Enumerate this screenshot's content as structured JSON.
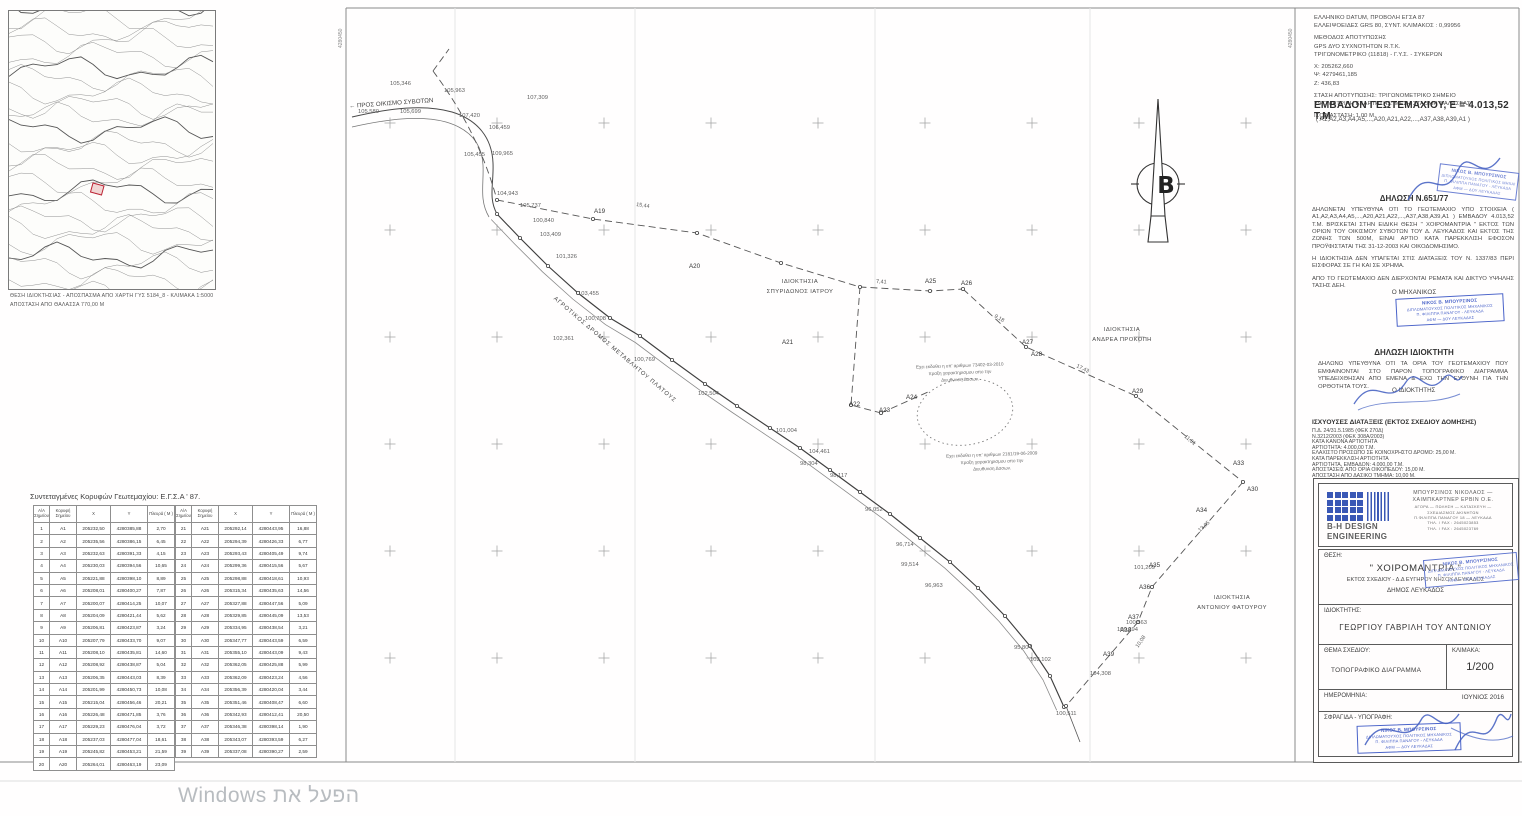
{
  "watermark": {
    "text": "הפעל את Windows"
  },
  "inset_map": {
    "caption_line1": "ΘΕΣΗ ΙΔΙΟΚΤΗΣΙΑΣ - ΑΠΟΣΠΑΣΜΑ ΑΠΟ ΧΑΡΤΗ ΓΥΣ 5184_8 - ΚΛΙΜΑΚΑ 1:5000",
    "caption_line2": "ΑΠΟΣΤΑΣΗ ΑΠΟ ΘΑΛΑΣΣΑ 770,00 Μ"
  },
  "survey_info": {
    "lines": [
      "ΕΛΛΗΝΙΚΟ DATUM, ΠΡΟΒΟΛΗ ΕΓΣΑ 87",
      "ΕΛΛΕΙΨΟΕΙΔΕΣ GRS 80, ΣΥΝΤ. ΚΛΙΜΑΚΟΣ :  0,99956",
      "ΜΕΘΟΔΟΣ ΑΠΟΤΥΠΩΣΗΣ",
      "GPS ΔΥΟ ΣΥΧΝΟΤΗΤΩΝ  R.T.K.",
      "ΤΡΙΓΩΝΟΜΕΤΡΙΚΟ (11818) - Γ.Υ.Σ. - ΣΥΚΕΡΩΝ",
      "X: 205262,660",
      "Ψ: 4279461,185",
      "Z: 436,83",
      "ΣΤΑΣΗ ΑΠΟΤΥΠΩΣΗΣ: ΤΡΙΓΩΝΟΜΕΤΡΙΚΟ ΣΗΜΕΙΟ",
      "ΥΨΟΜΕΤΡΙΚΗ ΕΞΑΡΤΗΣΗΣ: ΜΕΣΗ ΣΤΑΘΜΗ ΘΑΛΑΣΣΑΣ",
      "ΙΣΟΔΙΑΣΤΑΣΗ: 1,00 Μ."
    ]
  },
  "area": {
    "heading": "ΕΜΒΑΔΟΝ ΓΕΩΤΕΜΑΧΙΟΥ, Ε = 4.013,52 Τ.Μ",
    "vertices": "( Α1,Α2,Α3,Α4,Α5,...,Α20,Α21,Α22,...,Α37,Α38,Α39,Α1 )"
  },
  "declaration_651": {
    "title": "ΔΗΛΩΣΗ Ν.651/77",
    "paragraphs": [
      "ΔΗΛΩΝΕΤΑΙ ΥΠΕΥΘΥΝΑ ΟΤΙ ΤΟ ΓΕΩΤΕΜΑΧΙΟ ΥΠΟ ΣΤΟΙΧΕΙΑ ( Α1,Α2,Α3,Α4,Α5,...,Α20,Α21,Α22,...,Α37,Α38,Α39,Α1 ) ΕΜΒΑΔΟΥ 4.013,52 Τ.Μ. ΒΡΙΣΚΕΤΑΙ ΣΤΗΝ ΕΙΔΙΚΗ ΘΕΣΗ \" ΧΟΙΡΟΜΑΝΤΡΙΑ \" ΕΚΤΟΣ ΤΩΝ ΟΡΙΩΝ ΤΟΥ ΟΙΚΙΣΜΟΥ ΣΥΒΟΤΩΝ ΤΟΥ Δ. ΛΕΥΚΑΔΟΣ ΚΑΙ ΕΚΤΟΣ ΤΗΣ ΖΩΝΗΣ ΤΩΝ 500Μ, ΕΙΝΑΙ ΑΡΤΙΟ ΚΑΤΑ ΠΑΡΕΚΚΛΙΣΗ ΕΦΟΣΟΝ ΠΡΟΫΦΙΣΤΑΤΑΙ ΤΗΣ 31-12-2003 ΚΑΙ ΟΙΚΟΔΟΜΗΣΙΜΟ.",
      "Η ΙΔΙΟΚΤΗΣΙΑ ΔΕΝ ΥΠΑΓΕΤΑΙ ΣΤΙΣ ΔΙΑΤΑΞΕΙΣ ΤΟΥ Ν. 1337/83 ΠΕΡΙ ΕΙΣΦΟΡΑΣ ΣΕ ΓΗ ΚΑΙ ΣΕ ΧΡΗΜΑ.",
      "ΑΠΟ ΤΟ ΓΕΩΤΕΜΑΧΙΟ ΔΕΝ ΔΙΕΡΧΟΝΤΑΙ ΡΕΜΑΤΑ ΚΑΙ ΔΙΚΤΥΟ ΥΨΗΛΗΣ ΤΑΣΗΣ ΔΕΗ."
    ],
    "signer": "Ο ΜΗΧΑΝΙΚΟΣ"
  },
  "declaration_owner": {
    "title": "ΔΗΛΩΣΗ ΙΔΙΟΚΤΗΤΗ",
    "body": "ΔΗΛΩΝΩ ΥΠΕΥΘΥΝΑ ΟΤΙ ΤΑ ΟΡΙΑ ΤΟΥ ΓΕΩΤΕΜΑΧΙΟΥ ΠΟΥ ΕΜΦΑΙΝΟΝΤΑΙ ΣΤΟ ΠΑΡΟΝ ΤΟΠΟΓΡΑΦΙΚΟ ΔΙΑΓΡΑΜΜΑ ΥΠΕΔΕΙΧΘΗΣΑΝ ΑΠΟ ΕΜΕΝΑ & ΕΧΩ ΤΗΝ ΕΥΘΥΝΗ ΓΙΑ ΤΗΝ ΟΡΘΟΤΗΤΑ ΤΟΥΣ.",
    "signer": "Ο ΙΔΙΟΚΤΗΤΗΣ"
  },
  "provisions": {
    "title": "ΙΣΧΥΟΥΣΕΣ ΔΙΑΤΑΞΕΙΣ (ΕΚΤΟΣ ΣΧΕΔΙΟΥ ΔΟΜΗΣΗΣ)",
    "lines": [
      "Π.Δ. 24/31.5.1985 (ΦΕΚ 270Δ)",
      "Ν.3212/2003 (ΦΕΚ 308Α/2003)",
      "ΚΑΤΑ ΚΑΝΟΝΑ ΑΡΤΙΟΤΗΤΑ",
      "ΑΡΤΙΟΤΗΤΑ: 4.000,00 Τ.Μ.",
      "ΕΛΑΧΙΣΤΟ ΠΡΟΣΩΠΟ ΣΕ ΚΟΙΝΟΧΡΗΣΤΟ ΔΡΟΜΟ: 25,00 Μ.",
      "ΚΑΤΑ ΠΑΡΕΚΚΛΙΣΗ ΑΡΤΙΟΤΗΤΑ",
      "ΑΡΤΙΟΤΗΤΑ, ΕΜΒΑΔΟΝ: 4.000,00 Τ.Μ.",
      "ΑΠΟΣΤΑΣΕΙΣ ΑΠΟ ΟΡΙΑ ΟΙΚΟΠΕΔΟΥ: 15,00 Μ.",
      "ΑΠΟΣΤΑΣΗ ΑΠΟ ΔΑΣΙΚΟ ΤΜΗΜΑ: 10,00 Μ."
    ]
  },
  "title_block": {
    "brand_line1": "B-H DESIGN",
    "brand_line2": "ENGINEERING",
    "company_lines": [
      "ΜΠΟΥΡΣΙΝΟΣ ΝΙΚΟΛΑΟΣ —",
      "ΧΑΙΜΠΚΑΡΤΝΕΡ ΕΡΒΙΝ Ο.Ε."
    ],
    "detail_lines": [
      "ΑΓΟΡΑ — ΠΩΛΗΣΗ — ΚΑΤΑΣΚΕΥΗ —",
      "ΣΧΕΔΙΑΣΜΟΣ ΑΚΙΝΗΤΩΝ",
      "Π.ΦΙΛΙΠΠΑ ΠΑΝΑΓΟΥ 18 — ΛΕΥΚΑΔΑ",
      "ΤΗΛ. / FAX : 2645023853",
      "ΤΗΛ. / FAX : 2645023769"
    ],
    "thesi_label": "ΘΕΣΗ:",
    "thesi_value1": "\" ΧΟΙΡΟΜΑΝΤΡΙΑ \"",
    "thesi_value2": "ΕΚΤΟΣ ΣΧΕΔΙΟΥ - Δ.Δ ΕΥΓΗΡΟΥ ΝΗΣΟΥ ΛΕΥΚΑΔΟΣ",
    "thesi_value3": "ΔΗΜΟΣ ΛΕΥΚΑΔΟΣ",
    "owner_label": "ΙΔΙΟΚΤΗΤΗΣ:",
    "owner_value": "ΓΕΩΡΓΙΟΥ  ΓΑΒΡΙΛΗ ΤΟΥ ΑΝΤΩΝΙΟΥ",
    "subject_label": "ΘΕΜΑ ΣΧΕΔΙΟΥ:",
    "subject_value": "ΤΟΠΟΓΡΑΦΙΚΟ ΔΙΑΓΡΑΜΜΑ",
    "scale_label": "ΚΛΙΜΑΚΑ:",
    "scale_value": "1/200",
    "date_label": "ΗΜΕΡΟΜΗΝΙΑ:",
    "date_value": "ΙΟΥΝΙΟΣ  2016",
    "stamp_label": "ΣΦΡΑΓΙΔΑ - ΥΠΟΓΡΑΦΗ:"
  },
  "stamp": {
    "lines": [
      "ΝΙΚΟΣ Β. ΜΠΟΥΡΣΙΝΟΣ",
      "ΔΙΠΛΩΜΑΤΟΥΧΟΣ ΠΟΛΙΤΙΚΟΣ ΜΗΧΑΝΙΚΟΣ",
      "Π. ΦΙΛΙΠΠΑ ΠΑΝΑΓΟΥ - ΛΕΥΚΑΔΑ",
      "ΑΦΜ — ΔΟΥ ΛΕΥΚΑΔΑΣ"
    ]
  },
  "coords_table": {
    "title": "Συντεταγμένες Κορυφών Γεωτεμαχίου: Ε.Γ.Σ.Α ' 87.",
    "headers": [
      "Α/Α Σημείου",
      "Κορυφή Σημείου",
      "Χ",
      "Υ",
      "Πλευρά ( Μ )"
    ],
    "rows": [
      [
        "1",
        "Α1",
        "205232,50",
        "4280385,88",
        "2,70"
      ],
      [
        "2",
        "Α2",
        "205235,56",
        "4280386,15",
        "6,45"
      ],
      [
        "3",
        "Α3",
        "205232,63",
        "4280391,33",
        "4,15"
      ],
      [
        "4",
        "Α4",
        "205230,03",
        "4280394,56",
        "10,65"
      ],
      [
        "5",
        "Α5",
        "205221,88",
        "4280398,10",
        "8,89"
      ],
      [
        "6",
        "Α6",
        "205208,01",
        "4280400,27",
        "7,87"
      ],
      [
        "7",
        "Α7",
        "205200,07",
        "4280414,25",
        "10,07"
      ],
      [
        "8",
        "Α8",
        "205204,09",
        "4280421,44",
        "5,62"
      ],
      [
        "9",
        "Α9",
        "205206,81",
        "4280423,87",
        "3,24"
      ],
      [
        "10",
        "Α10",
        "205207,79",
        "4280433,70",
        "9,07"
      ],
      [
        "11",
        "Α11",
        "205208,10",
        "4280435,81",
        "14,60"
      ],
      [
        "12",
        "Α12",
        "205208,92",
        "4280438,87",
        "5,04"
      ],
      [
        "13",
        "Α13",
        "205206,35",
        "4280443,03",
        "8,39"
      ],
      [
        "14",
        "Α14",
        "205201,99",
        "4280450,73",
        "10,08"
      ],
      [
        "15",
        "Α15",
        "205215,04",
        "4280456,46",
        "20,21"
      ],
      [
        "16",
        "Α16",
        "205226,48",
        "4280471,85",
        "3,76"
      ],
      [
        "17",
        "Α17",
        "205229,23",
        "4280476,04",
        "3,72"
      ],
      [
        "18",
        "Α18",
        "205237,03",
        "4280477,04",
        "18,61"
      ],
      [
        "19",
        "Α19",
        "205245,82",
        "4280453,21",
        "21,59"
      ],
      [
        "20",
        "Α20",
        "205264,01",
        "4280463,19",
        "23,09"
      ],
      [
        "21",
        "Α21",
        "205292,14",
        "4280443,95",
        "16,88"
      ],
      [
        "22",
        "Α22",
        "205294,39",
        "4280426,33",
        "6,77"
      ],
      [
        "23",
        "Α23",
        "205293,43",
        "4280405,49",
        "9,74"
      ],
      [
        "24",
        "Α24",
        "205299,36",
        "4280415,56",
        "5,67"
      ],
      [
        "25",
        "Α25",
        "205298,88",
        "4280418,61",
        "10,93"
      ],
      [
        "26",
        "Α26",
        "205315,34",
        "4280435,63",
        "14,56"
      ],
      [
        "27",
        "Α27",
        "205327,88",
        "4280447,56",
        "5,09"
      ],
      [
        "28",
        "Α28",
        "205329,85",
        "4280445,09",
        "13,53"
      ],
      [
        "29",
        "Α29",
        "205334,95",
        "4280438,54",
        "3,21"
      ],
      [
        "30",
        "Α30",
        "205347,77",
        "4280443,59",
        "6,59"
      ],
      [
        "31",
        "Α31",
        "205355,10",
        "4280443,09",
        "9,43"
      ],
      [
        "32",
        "Α32",
        "205362,05",
        "4280425,88",
        "5,99"
      ],
      [
        "33",
        "Α33",
        "205362,09",
        "4280423,24",
        "4,56"
      ],
      [
        "34",
        "Α34",
        "205356,39",
        "4280420,04",
        "3,44"
      ],
      [
        "35",
        "Α35",
        "205351,46",
        "4280408,47",
        "6,60"
      ],
      [
        "36",
        "Α36",
        "205342,93",
        "4280412,41",
        "20,50"
      ],
      [
        "37",
        "Α37",
        "205346,38",
        "4280398,14",
        "1,90"
      ],
      [
        "38",
        "Α38",
        "205343,07",
        "4280393,59",
        "6,27"
      ],
      [
        "39",
        "Α39",
        "205337,08",
        "4280390,27",
        "2,59"
      ]
    ]
  },
  "drawing": {
    "direction_label": "← ΠΡΟΣ ΟΙΚΙΣΜΟ ΣΥΒΟΤΩΝ",
    "road_label": "ΑΓΡΟΤΙΚΟΣ ΔΡΟΜΟΣ ΜΕΤΑΒΛΗΤΟΥ ΠΛΑΤΟΥΣ",
    "north_letter": "Β",
    "owners": [
      {
        "line1": "ΙΔΙΟΚΤΗΣΙΑ",
        "line2": "ΣΠΥΡΙΔΩΝΟΣ ΙΑΤΡΟΥ",
        "x": 800,
        "y": 278
      },
      {
        "line1": "ΙΔΙΟΚΤΗΣΙΑ",
        "line2": "ΑΝΔΡΕΑ ΠΡΟΚΟΠΗ",
        "x": 1122,
        "y": 326
      },
      {
        "line1": "ΙΔΙΟΚΤΗΣΙΑ",
        "line2": "ΑΝΤΩΝΙΟΥ ΦΑΤΟΥΡΟΥ",
        "x": 1232,
        "y": 594
      }
    ],
    "notes": [
      {
        "x": 898,
        "y": 363,
        "lines": [
          "Εχει εκδοθει η υπ' αριθμων 73402-03-2010",
          "πραξη χαρακτηρισμου απο την",
          "Διευθυνση Δασων."
        ]
      },
      {
        "x": 930,
        "y": 452,
        "lines": [
          "Εχει εκδοθει η υπ' αριθμων 2181/19-06-2009",
          "πραξη χαρακτηρισμου απο την",
          "Διευθυνση Δασων."
        ]
      }
    ],
    "grid_labels": [
      {
        "t": "4280450",
        "x": 342,
        "y": 48
      },
      {
        "t": "4280450",
        "x": 1292,
        "y": 48
      }
    ],
    "point_labels": [
      {
        "t": "105,346",
        "x": 390,
        "y": 85
      },
      {
        "t": "105,963",
        "x": 444,
        "y": 92
      },
      {
        "t": "107,309",
        "x": 527,
        "y": 99
      },
      {
        "t": "105,580",
        "x": 358,
        "y": 113
      },
      {
        "t": "105,699",
        "x": 400,
        "y": 113
      },
      {
        "t": "107,420",
        "x": 459,
        "y": 117
      },
      {
        "t": "106,459",
        "x": 489,
        "y": 129
      },
      {
        "t": "105,455",
        "x": 464,
        "y": 156
      },
      {
        "t": "109,965",
        "x": 492,
        "y": 155
      },
      {
        "t": "104,943",
        "x": 497,
        "y": 195
      },
      {
        "t": "105,737",
        "x": 520,
        "y": 207
      },
      {
        "t": "100,840",
        "x": 533,
        "y": 222
      },
      {
        "t": "103,409",
        "x": 540,
        "y": 236
      },
      {
        "t": "101,326",
        "x": 556,
        "y": 258
      },
      {
        "t": "103,455",
        "x": 578,
        "y": 295
      },
      {
        "t": "100,708",
        "x": 585,
        "y": 320
      },
      {
        "t": "102,361",
        "x": 553,
        "y": 340
      },
      {
        "t": "100,769",
        "x": 634,
        "y": 361
      },
      {
        "t": "102,504",
        "x": 698,
        "y": 395
      },
      {
        "t": "101,004",
        "x": 776,
        "y": 432
      },
      {
        "t": "104,461",
        "x": 809,
        "y": 453
      },
      {
        "t": "98,304",
        "x": 800,
        "y": 465
      },
      {
        "t": "98,117",
        "x": 830,
        "y": 477
      },
      {
        "t": "96,052",
        "x": 865,
        "y": 511
      },
      {
        "t": "96,714",
        "x": 896,
        "y": 546
      },
      {
        "t": "99,514",
        "x": 901,
        "y": 566
      },
      {
        "t": "96,963",
        "x": 925,
        "y": 587
      },
      {
        "t": "95,804",
        "x": 1014,
        "y": 649
      },
      {
        "t": "102,102",
        "x": 1030,
        "y": 661
      },
      {
        "t": "104,308",
        "x": 1090,
        "y": 675
      },
      {
        "t": "100,511",
        "x": 1056,
        "y": 715
      },
      {
        "t": "100,563",
        "x": 1126,
        "y": 624
      },
      {
        "t": "101,209",
        "x": 1134,
        "y": 569
      },
      {
        "t": "100,394",
        "x": 1117,
        "y": 631
      }
    ],
    "vertex_labels": [
      {
        "t": "Α19",
        "x": 594,
        "y": 213
      },
      {
        "t": "Α20",
        "x": 689,
        "y": 268
      },
      {
        "t": "Α21",
        "x": 782,
        "y": 344
      },
      {
        "t": "Α22",
        "x": 849,
        "y": 406
      },
      {
        "t": "Α23",
        "x": 879,
        "y": 412
      },
      {
        "t": "Α24",
        "x": 906,
        "y": 399
      },
      {
        "t": "Α25",
        "x": 925,
        "y": 283
      },
      {
        "t": "Α26",
        "x": 961,
        "y": 285
      },
      {
        "t": "Α27",
        "x": 1022,
        "y": 344
      },
      {
        "t": "Α28",
        "x": 1031,
        "y": 356
      },
      {
        "t": "Α29",
        "x": 1132,
        "y": 393
      },
      {
        "t": "Α30",
        "x": 1247,
        "y": 491
      },
      {
        "t": "Α33",
        "x": 1233,
        "y": 465
      },
      {
        "t": "Α34",
        "x": 1196,
        "y": 512
      },
      {
        "t": "Α35",
        "x": 1149,
        "y": 567
      },
      {
        "t": "Α36",
        "x": 1139,
        "y": 589
      },
      {
        "t": "Α37",
        "x": 1128,
        "y": 619
      },
      {
        "t": "Α38",
        "x": 1120,
        "y": 632
      },
      {
        "t": "Α39",
        "x": 1103,
        "y": 656
      }
    ],
    "distance_labels": [
      {
        "t": "15,44",
        "x": 636,
        "y": 206,
        "r": 8
      },
      {
        "t": "7,41",
        "x": 876,
        "y": 283,
        "r": 3
      },
      {
        "t": "9,18",
        "x": 994,
        "y": 317,
        "r": 30
      },
      {
        "t": "17,43",
        "x": 1076,
        "y": 367,
        "r": 26
      },
      {
        "t": "11,51",
        "x": 1184,
        "y": 437,
        "r": 40
      },
      {
        "t": "13,05",
        "x": 1200,
        "y": 532,
        "r": -42
      },
      {
        "t": "10,08",
        "x": 1138,
        "y": 648,
        "r": -55
      }
    ]
  }
}
